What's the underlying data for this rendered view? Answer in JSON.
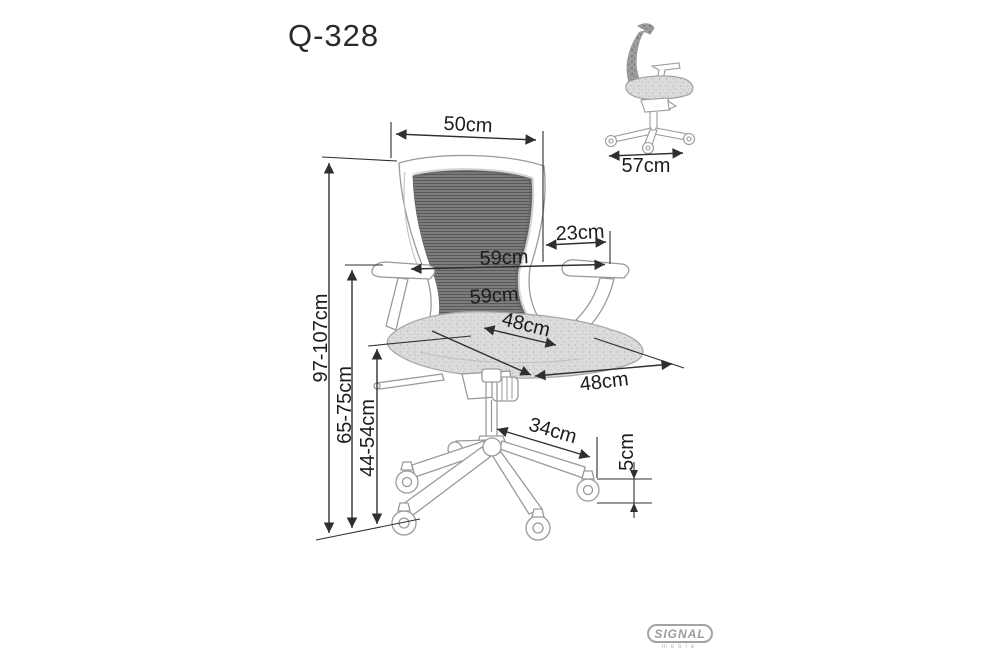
{
  "title": "Q-328",
  "dims": {
    "backrest_width": "50cm",
    "armrest_depth": "23cm",
    "overall_width": "59cm",
    "overall_depth": "59cm",
    "seat_width": "48cm",
    "seat_depth": "48cm",
    "total_height": "97-107cm",
    "armrest_height": "65-75cm",
    "seat_height": "44-54cm",
    "base_spread": "34cm",
    "caster_height": "5cm",
    "side_view_depth": "57cm"
  },
  "logo": {
    "brand": "SIGNAL",
    "subtext": "meble"
  },
  "colors": {
    "dimension_line": "#2f2f2f",
    "chair_line": "#9a9a9a",
    "mesh_fill": "#7a7a7a",
    "seat_fill": "#dcdcdc",
    "logo_gray": "#9b9b9b"
  }
}
